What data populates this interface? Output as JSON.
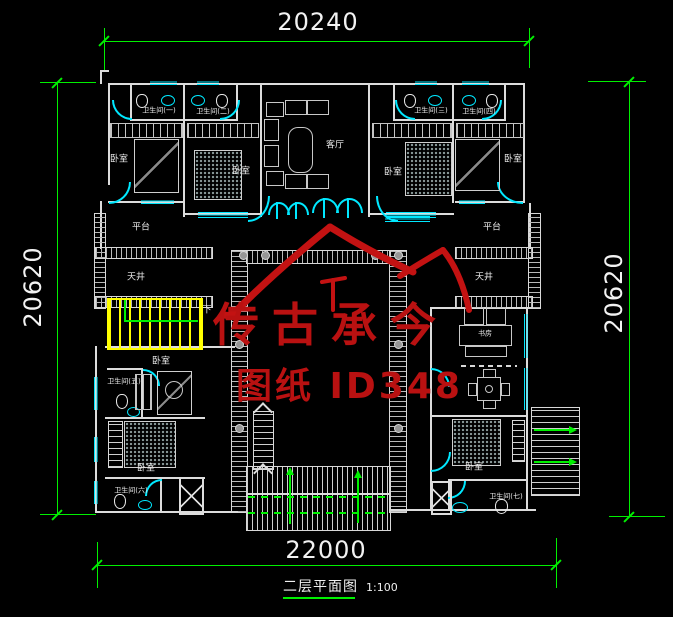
{
  "meta": {
    "title": "二层平面图",
    "scale": "1:100"
  },
  "watermark": {
    "brand": "传古承今",
    "sheet_id": "图纸 ID348"
  },
  "dimensions": {
    "top": "20240",
    "bottom": "22000",
    "left": "20620",
    "right": "20620"
  },
  "labels": {
    "bedroom": "卧室",
    "living_room": "客厅",
    "study": "书房",
    "platform": "平台",
    "lightwell": "天井",
    "down": "下",
    "bath_1": "卫生间(一)",
    "bath_2": "卫生间(二)",
    "bath_3": "卫生间(三)",
    "bath_4": "卫生间(四)",
    "bath_5": "卫生间(五)",
    "bath_6": "卫生间(六)",
    "bath_7": "卫生间(七)"
  },
  "colors": {
    "background": "#000000",
    "walls": "#dcdcdc",
    "fixtures_cyan": "#00e8ff",
    "dimension_green": "#00f000",
    "stair_yellow": "#ffff00",
    "watermark_red": "#b91111",
    "text_white": "#f2f2f2"
  }
}
